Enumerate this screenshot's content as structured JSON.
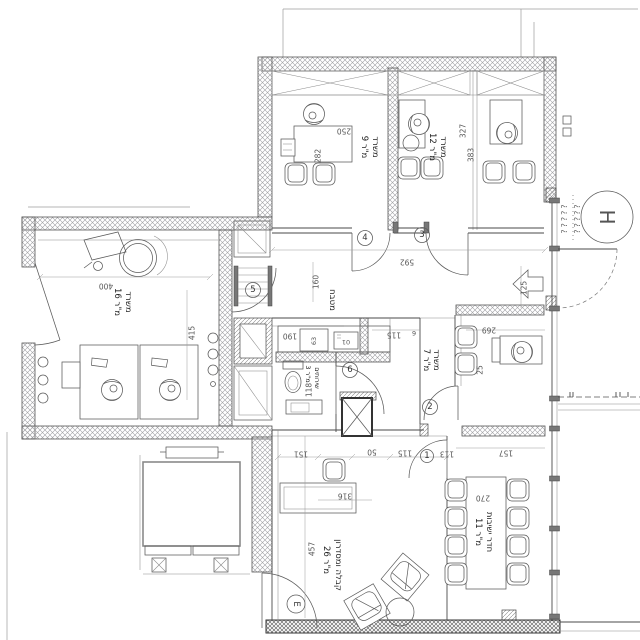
{
  "drawing": {
    "type": "architectural-floor-plan",
    "language": "Hebrew",
    "ink": "#3c3c3c",
    "paper": "#ffffff"
  },
  "rooms": [
    {
      "name": "משרד",
      "area": "9 מ\"ר"
    },
    {
      "name": "משרד",
      "area": "12 מ\"ר"
    },
    {
      "name": "משרד",
      "area": "16 מ\"ר"
    },
    {
      "name": "משרד",
      "area": "7 מ\"ר"
    },
    {
      "name": "שירותים",
      "area": "3 מ\"ר"
    },
    {
      "name": "מטבח",
      "area": ""
    },
    {
      "name": "קבלה ומסדרון",
      "area": "26 מ\"ר"
    },
    {
      "name": "חדר ישיבות",
      "area": "11 מ\"ר"
    }
  ],
  "dimensions": {
    "d250": "250",
    "d282": "282",
    "d327": "327",
    "d383": "383",
    "d400": "400",
    "d415": "415",
    "d592": "592",
    "d125": "125",
    "d160": "160",
    "d190": "190",
    "d63": "63",
    "d10": "01",
    "d115": "115",
    "d6": "6",
    "d118": "118",
    "d269": "269",
    "d25": "25",
    "d157": "157",
    "d113": "113",
    "d50": "50",
    "d151": "151",
    "d316": "316",
    "d457": "457",
    "d270": "270"
  },
  "tags": {
    "t1": "1",
    "t2": "2",
    "t3": "3",
    "t4": "4",
    "t5": "5",
    "t6": "6",
    "entrance": "E"
  },
  "symbols": {
    "elevator_hall": "H",
    "coil_marks": "?????"
  }
}
